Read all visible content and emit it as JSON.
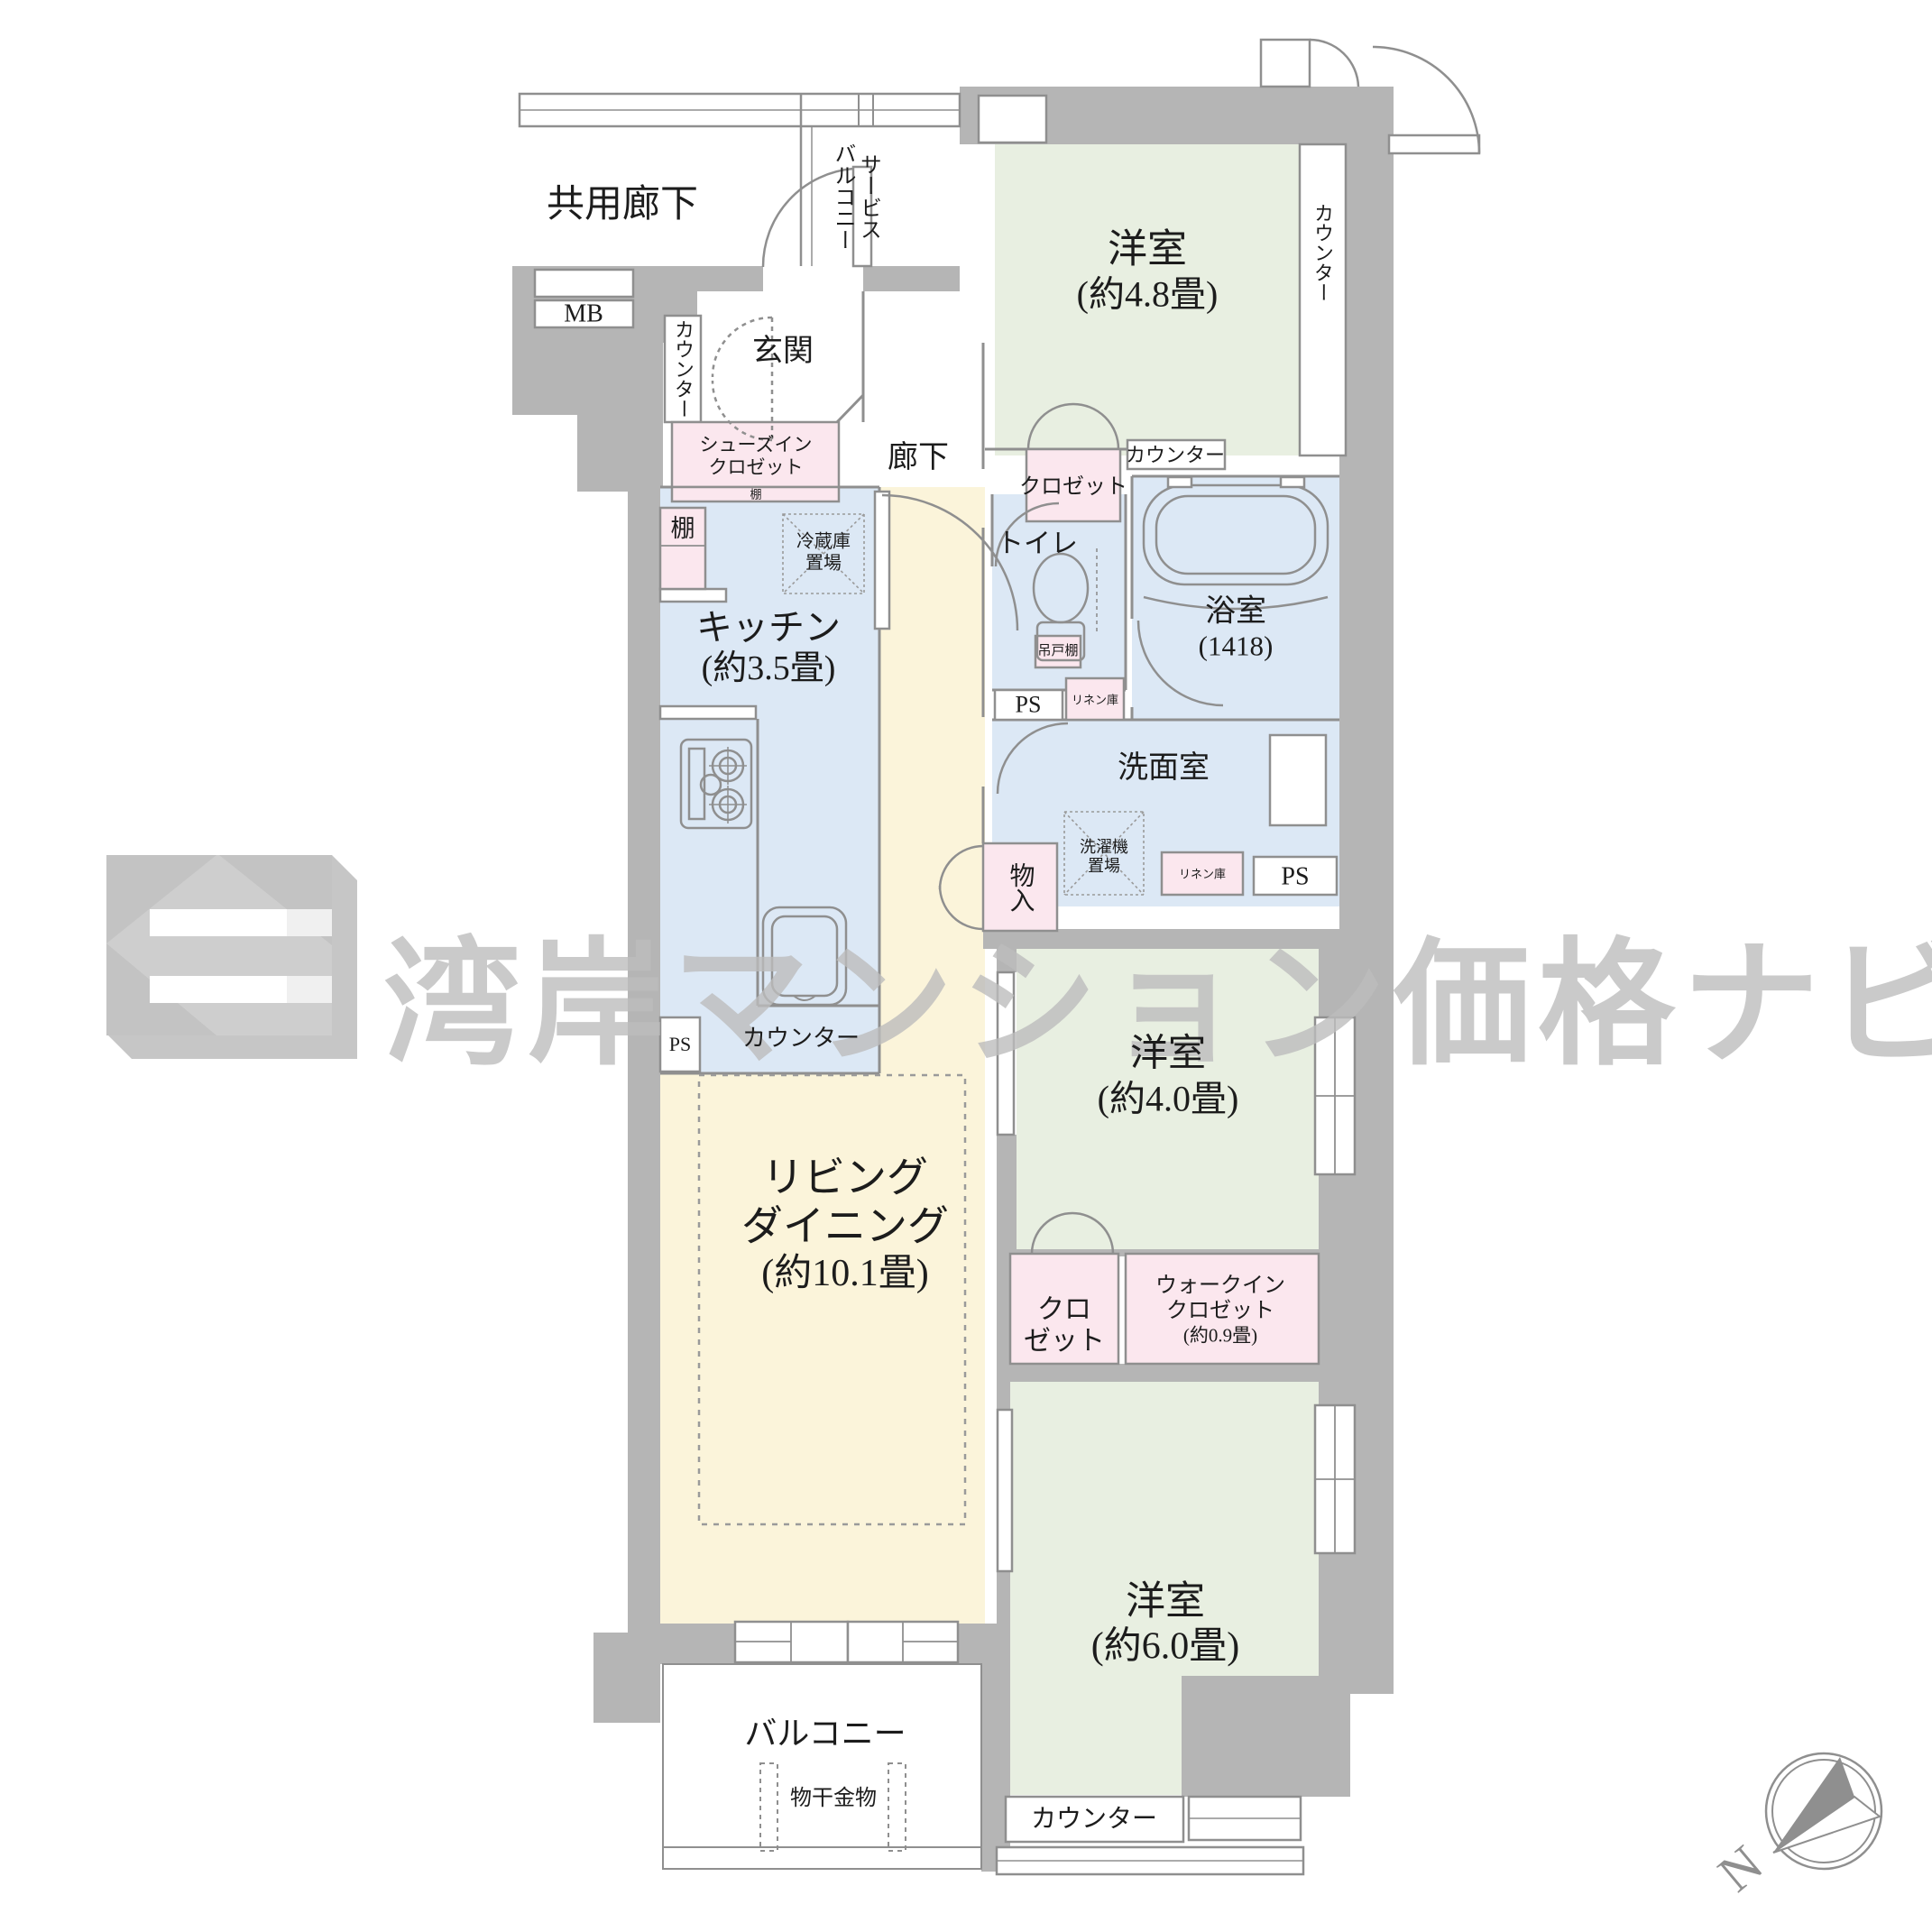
{
  "palette": {
    "wall_gray": "#b5b5b5",
    "line_gray": "#8f8f8f",
    "room_green": "#e8efe1",
    "water_blue": "#dce8f5",
    "living_yellow": "#fbf4da",
    "closet_pink": "#fbe7ee",
    "watermark_gray": "#bdbdbd",
    "text_black": "#1c1c1c"
  },
  "watermark": {
    "text": "湾岸マンション価格ナビ"
  },
  "compass": {
    "north_label": "N"
  },
  "labels": {
    "common_corridor": {
      "lines": [
        "共用廊下"
      ]
    },
    "service_balcony": {
      "lines": [
        "サービス",
        "バルコニー"
      ]
    },
    "mb": {
      "lines": [
        "MB"
      ]
    },
    "entrance": {
      "lines": [
        "玄関"
      ]
    },
    "entrance_counter": {
      "lines": [
        "カウンター"
      ]
    },
    "shoes_closet": {
      "lines": [
        "シューズイン",
        "クロゼット"
      ]
    },
    "shoes_shelf": {
      "lines": [
        "棚"
      ]
    },
    "corridor": {
      "lines": [
        "廊下"
      ]
    },
    "closet_48": {
      "lines": [
        "クロゼット"
      ]
    },
    "counter_48_side": {
      "lines": [
        "カウンター"
      ]
    },
    "counter_48_bottom": {
      "lines": [
        "カウンター"
      ]
    },
    "room_48": {
      "lines": [
        "洋室",
        "(約4.8畳)"
      ]
    },
    "kitchen_shelf": {
      "lines": [
        "棚"
      ]
    },
    "fridge": {
      "lines": [
        "冷蔵庫",
        "置場"
      ]
    },
    "kitchen": {
      "lines": [
        "キッチン",
        "(約3.5畳)"
      ]
    },
    "toilet": {
      "lines": [
        "トイレ"
      ]
    },
    "hanging_cupboard": {
      "lines": [
        "吊戸棚"
      ]
    },
    "ps_toilet": {
      "lines": [
        "PS"
      ]
    },
    "linen_top": {
      "lines": [
        "リネン庫"
      ]
    },
    "bath": {
      "lines": [
        "浴室",
        "(1418)"
      ]
    },
    "washroom": {
      "lines": [
        "洗面室"
      ]
    },
    "washing_machine": {
      "lines": [
        "洗濯機",
        "置場"
      ]
    },
    "linen_bottom": {
      "lines": [
        "リネン庫"
      ]
    },
    "ps_bottom": {
      "lines": [
        "PS"
      ]
    },
    "storage": {
      "lines": [
        "物入"
      ]
    },
    "ps_kitchen": {
      "lines": [
        "PS"
      ]
    },
    "counter_kitchen": {
      "lines": [
        "カウンター"
      ]
    },
    "living": {
      "lines": [
        "リビング",
        "ダイニング",
        "(約10.1畳)"
      ]
    },
    "room_40": {
      "lines": [
        "洋室",
        "(約4.0畳)"
      ]
    },
    "closet_40": {
      "lines": [
        "クロ",
        "ゼット"
      ]
    },
    "wic": {
      "lines": [
        "ウォークイン",
        "クロゼット",
        "(約0.9畳)"
      ]
    },
    "room_60": {
      "lines": [
        "洋室",
        "(約6.0畳)"
      ]
    },
    "balcony": {
      "lines": [
        "バルコニー"
      ]
    },
    "laundry_hardware": {
      "lines": [
        "物干金物"
      ]
    },
    "counter_bottom": {
      "lines": [
        "カウンター"
      ]
    }
  }
}
